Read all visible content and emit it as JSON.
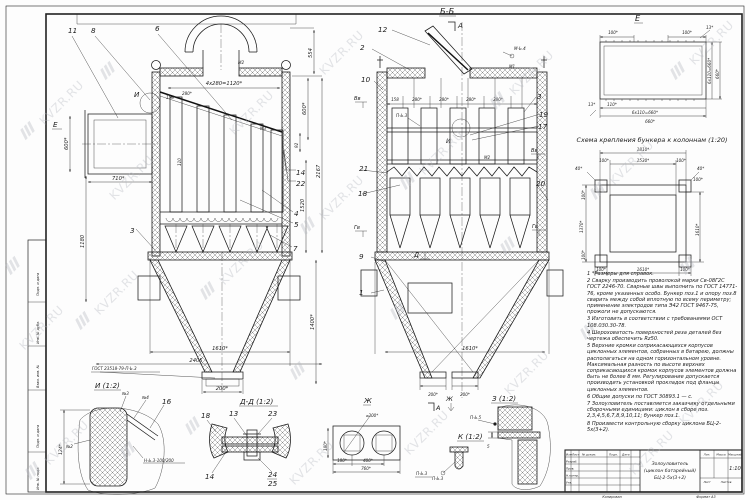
{
  "watermark": {
    "text": "KVZR.RU"
  },
  "sheet": {
    "stamps": [
      "Подп. и дата",
      "Инв. № дубл.",
      "Взам. инв. №",
      "Подп. и дата",
      "Инв. № подл."
    ],
    "footer_copy": "Копировал",
    "footer_format": "Формат А3"
  },
  "front": {
    "pos": {
      "p3": "3",
      "p4": "4",
      "p5": "5",
      "p6": "6",
      "p7": "7",
      "p8": "8",
      "p11": "11",
      "p14": "14",
      "p22": "22"
    },
    "markers": {
      "e": "Е",
      "i": "И",
      "m2": "М2",
      "m3": "М3"
    },
    "dims": {
      "top": "4х280=1120*",
      "d158": "158",
      "d280": "280*",
      "d110": "110",
      "l600": "600*",
      "l710": "710*",
      "l1180": "1180",
      "r554": "554",
      "r600": "600*",
      "r92": "92",
      "r1520": "1520",
      "r2167": "2167",
      "r1400": "1400*",
      "b1610": "1610*",
      "b2405": "2405",
      "b200": "200*"
    },
    "weld_note": "ГОСТ 23518-79-П-Ь.3"
  },
  "sec": {
    "title": "Б-Б",
    "pos": {
      "p1": "1",
      "p2": "2",
      "p3": "3",
      "p9": "9",
      "p10": "10",
      "p12": "12",
      "p17": "17",
      "p18": "18",
      "p19": "19",
      "p20": "20",
      "p21": "21"
    },
    "markers": {
      "a": "А",
      "vv": "Вв",
      "gv": "Гв",
      "i": "И",
      "d": "Д",
      "zh": "Ж",
      "m1": "М1",
      "m2": "М2",
      "mb4": "М-Ь.4",
      "pb3": "П-Ь.3"
    },
    "dims": {
      "d158": "158",
      "d280a": "280*",
      "d280b": "280*",
      "d280c": "280*",
      "d280d": "280*",
      "b1610": "1610*",
      "b200l": "200*",
      "b200r": "200*"
    }
  },
  "dete": {
    "title": "Е",
    "dims": {
      "t100l": "100*",
      "t100r": "100*",
      "t13": "13*",
      "r660c": "6х110=660*",
      "r660": "660*",
      "b13": "13*",
      "b110": "110*",
      "b660c": "6х110=660*",
      "b660": "660*"
    }
  },
  "scheme": {
    "title": "Схема крепления бункера к колоннам (1:20)",
    "dims": {
      "t1810": "1810*",
      "t100l": "100*",
      "t1530": "1530*",
      "t100r": "100*",
      "t40": "40*",
      "l40": "40*",
      "l100t": "100*",
      "l1370": "1370*",
      "l100b": "100*",
      "r100": "100*",
      "r1610": "1610*",
      "b100l": "100*",
      "b1610": "1610*",
      "b100r": "100*"
    }
  },
  "notes": {
    "items": [
      "1 *Размеры для справок.",
      "2 Сварку производить проволокой марки Св-08Г2С ГОСТ 2246-70. Сварные швы выполнить по ГОСТ 14771-76, кроме указанных особо. Бункер поз.1 и опору поз.8 сварить между собой вплотную по всему периметру; применение электродов типа Э42 ГОСТ 9467-75, прожоги не допускаются.",
      "3 Изготовить в соответствии с требованиями ОСТ 108.030.30-78.",
      "4 Шероховатость поверхностей реза деталей без чертежа обеспечить Rz50.",
      "5 Верхние кромки соприкасающихся корпусов циклонных элементов, собранных в батарею, должны располагаться на одном горизонтальном уровне. Максимальная разность по высоте верхних соприкасающихся кромок корпусов элементов должна быть не более 8 мм. Регулирование допускается производить установкой прокладок под фланцы циклонных элементов.",
      "6 Общие допуски по ГОСТ 30893.1 — с.",
      "7 Золоуловитель поставляется заказчику отдельными сборочными единицами: циклон в сборе поз. 2,3,4,5,6,7,8,9,10,11; бункер поз.1.",
      "8 Произвести контрольную сборку циклона БЦ-2-5х(3+2)."
    ]
  },
  "deti": {
    "title": "И (1:2)",
    "dims": {
      "d124": "124*"
    },
    "labels": {
      "n2": "№2",
      "n3": "№3",
      "n4": "№4",
      "p16": "16",
      "weld": "Н-Ь.3-100/200"
    }
  },
  "detdd": {
    "title": "Д-Д (1:2)",
    "pos": {
      "p13": "13",
      "p14": "14",
      "p18": "18",
      "p23": "23",
      "p24": "24",
      "p25": "25"
    }
  },
  "detzh": {
    "title": "Ж",
    "dims": {
      "d300": "⌀300*",
      "l180": "180*",
      "b180": "180*",
      "b400": "400*",
      "b760": "760*"
    },
    "weld": "П-Ь.3"
  },
  "detz": {
    "title": "З (1:2)",
    "weld": "П-Ь.5",
    "dim5": "5"
  },
  "detk": {
    "title": "К (1:2)",
    "weld": "П-Ь.3"
  },
  "tb": {
    "name1": "Золоуловитель",
    "name2": "(циклон батарейный)",
    "name3": "БЦ-2-5х(3+2)",
    "scale": "1:10",
    "cols": {
      "lit": "Лит.",
      "mass": "Масса",
      "scale": "Масштаб",
      "list": "Лист",
      "listov": "Листов"
    },
    "rows": {
      "izm": "Изм.",
      "list": "Лист",
      "doc": "№ докум.",
      "podp": "Подп.",
      "data": "Дата",
      "razrab": "Разраб.",
      "prov": "Пров.",
      "nkontr": "Н.контр.",
      "utv": "Утв."
    }
  }
}
